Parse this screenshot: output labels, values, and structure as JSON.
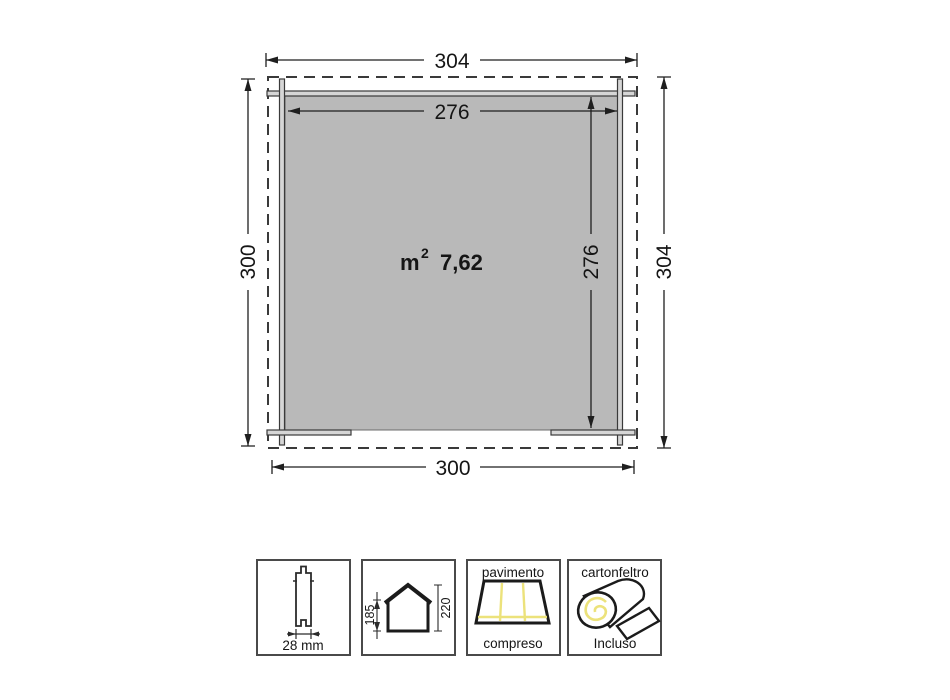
{
  "plan": {
    "area": {
      "unit": "m",
      "exponent": "2",
      "value": "7,62"
    },
    "dims": {
      "roof_width_top": "304",
      "inner_width_top": "276",
      "left_depth": "300",
      "inner_depth_right": "276",
      "roof_depth_right": "304",
      "wall_width_bottom": "300"
    }
  },
  "legend": {
    "plank": {
      "thickness_label": "28 mm"
    },
    "house": {
      "eave_height": "185",
      "ridge_height": "220"
    },
    "floor": {
      "line1": "pavimento",
      "line2": "compreso"
    },
    "felt": {
      "line1": "cartonfeltro",
      "line2": "Incluso"
    }
  },
  "colors": {
    "floor_fill": "#b9b9b9",
    "line": "#3a3a3a",
    "dimension": "#1f1f1f",
    "accent_yellow": "#ece27b"
  }
}
